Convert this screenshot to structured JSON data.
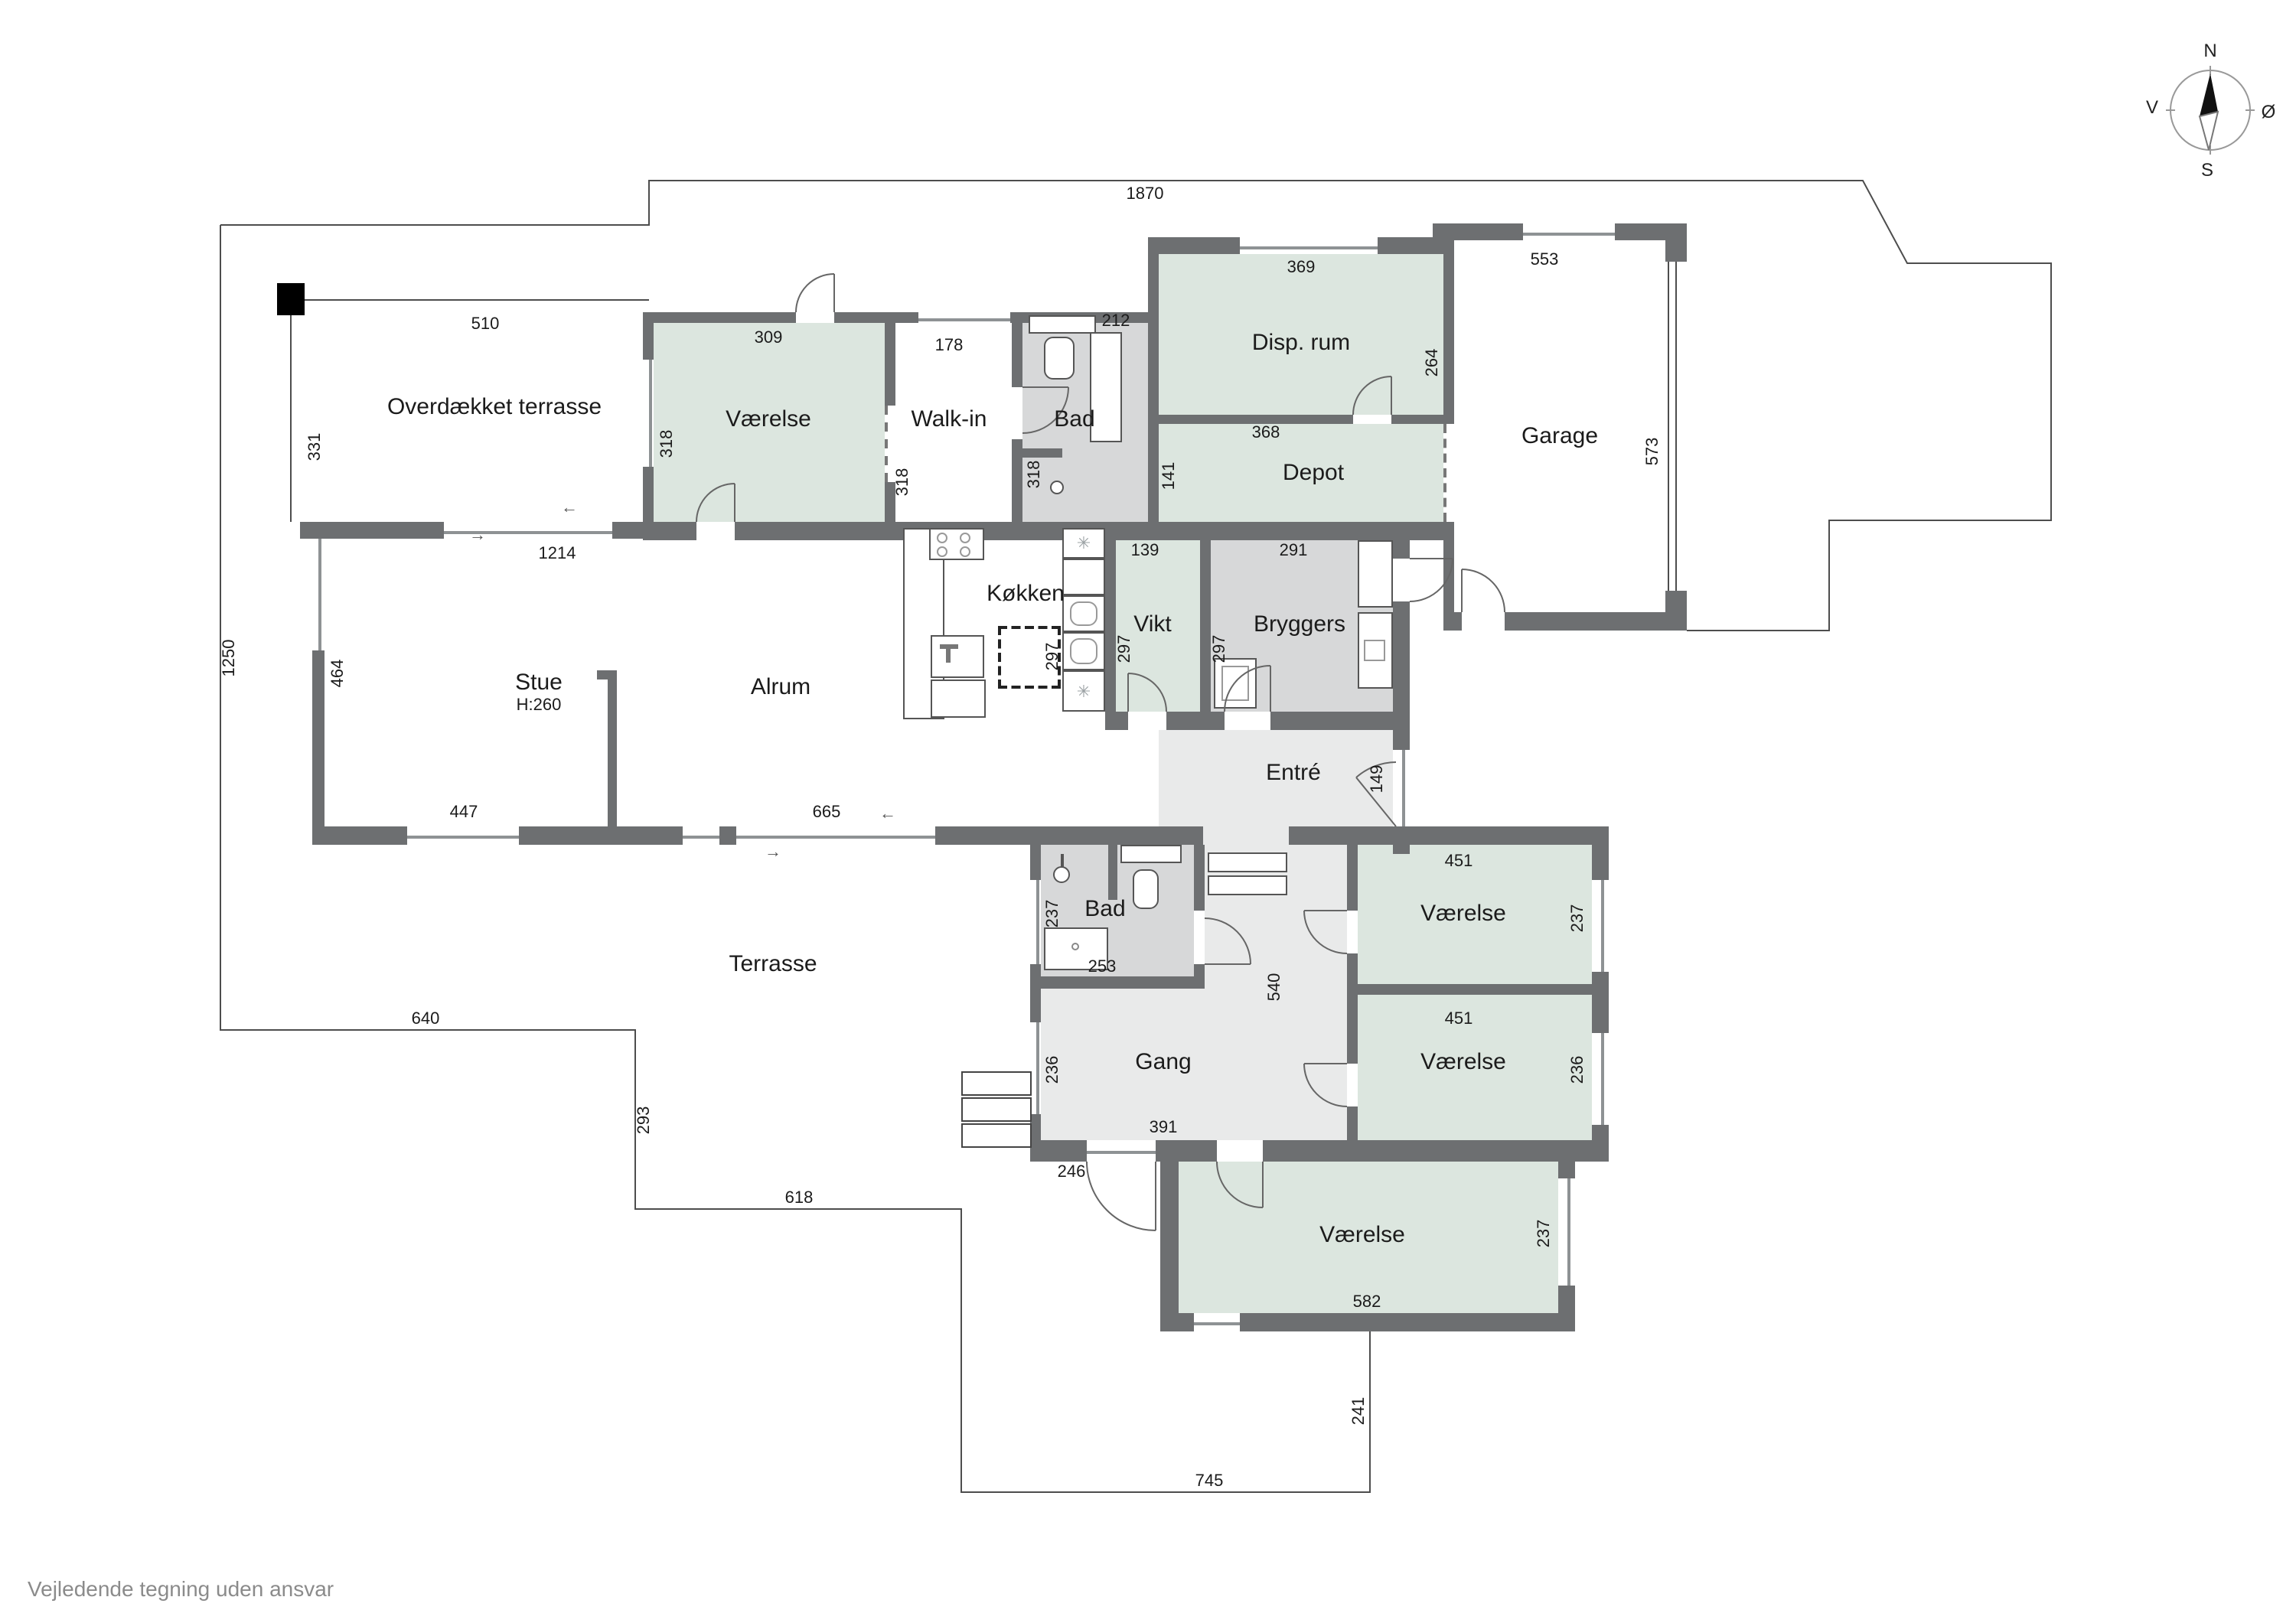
{
  "page": {
    "disclaimer": "Vejledende tegning uden ansvar"
  },
  "compass": {
    "north": "N",
    "south": "S",
    "west": "V",
    "east": "Ø"
  },
  "colors": {
    "wall": "#6d6f71",
    "room_green": "#dce6df",
    "room_gray": "#d7d8d9",
    "hall_light": "#e9eaea",
    "outline": "#4d4d4d"
  },
  "icons": {
    "fridge": "✳",
    "arrow_right": "→",
    "arrow_left": "←"
  },
  "rooms": {
    "overdaekket_terrasse": "Overdækket terrasse",
    "vaerelse_nord": "Værelse",
    "walk_in": "Walk-in",
    "bad_nord": "Bad",
    "disp_rum": "Disp. rum",
    "depot": "Depot",
    "garage": "Garage",
    "stue": "Stue",
    "stue_height": "H:260",
    "alrum": "Alrum",
    "koekken": "Køkken",
    "vikt": "Vikt",
    "bryggers": "Bryggers",
    "entre": "Entré",
    "terrasse": "Terrasse",
    "bad_syd": "Bad",
    "gang": "Gang",
    "vaerelse_1": "Værelse",
    "vaerelse_2": "Værelse",
    "vaerelse_3": "Værelse"
  },
  "dims": {
    "d1870": "1870",
    "d510": "510",
    "d331": "331",
    "d1250": "1250",
    "d1214": "1214",
    "d309": "309",
    "d318_a": "318",
    "d178": "178",
    "d318_b": "318",
    "d212": "212",
    "d318_c": "318",
    "d369": "369",
    "d264": "264",
    "d368": "368",
    "d141": "141",
    "d553": "553",
    "d573": "573",
    "d464": "464",
    "d447": "447",
    "d665": "665",
    "d139": "139",
    "d297_island": "297",
    "d297_vikt": "297",
    "d291": "291",
    "d297_bryggers": "297",
    "d149": "149",
    "d451_1": "451",
    "d237_1": "237",
    "d451_2": "451",
    "d236_2": "236",
    "d582": "582",
    "d237_3": "237",
    "d540": "540",
    "d253": "253",
    "d237_bad": "237",
    "d236_gang": "236",
    "d391": "391",
    "d246": "246",
    "d640": "640",
    "d293": "293",
    "d618": "618",
    "d745": "745",
    "d241": "241"
  }
}
